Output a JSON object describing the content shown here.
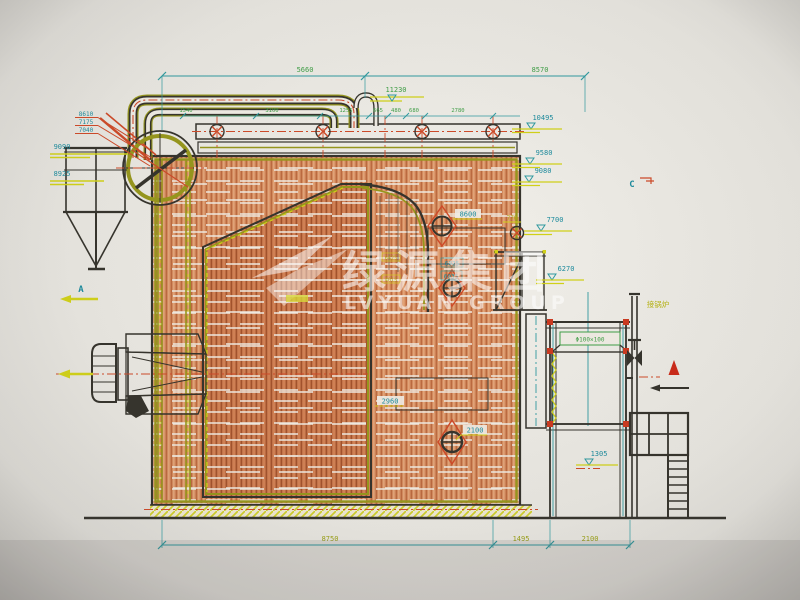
{
  "watermark": {
    "cn": "绿源集团",
    "en": "LVYUAN GROUP",
    "logo": "swoosh-bird"
  },
  "dims": {
    "top_left_span": "5660",
    "top_right_span": "8570",
    "peak_elevation": "11230",
    "top_row": [
      "1540",
      "3100",
      "1255",
      "665",
      "480",
      "680",
      "2780"
    ],
    "bottom": [
      "8750",
      "1495",
      "2100"
    ]
  },
  "elev_right": {
    "e1": "10495",
    "e2": "9580",
    "e3": "9080",
    "e4": "7700",
    "e5": "6270",
    "e6": "1305"
  },
  "elev_left": {
    "s1": "8610",
    "s2": "7175",
    "s3": "7040",
    "e1": "9090",
    "e2": "8925"
  },
  "labels": {
    "manhole_upper": "8600",
    "pipe_stub": "770",
    "box1": "6025",
    "box2": "6035",
    "ybox1": "6425",
    "ybox2": "4015",
    "superheater": "2960",
    "manhole_lower": "2100"
  },
  "markers": {
    "a": "A",
    "c": "C"
  },
  "notes": {
    "econ_spec": "Φ100×100",
    "pipe_cn": "接锅炉"
  },
  "colors": {
    "paper": "#efede7",
    "hatch_orange": "#db9365",
    "line_dark": "#35332c",
    "olive": "#97971c",
    "teal": "#2f9aa0",
    "red_centerline": "#cf4a28",
    "yellow": "#d2d218",
    "coil_red": "#7c2f16"
  }
}
